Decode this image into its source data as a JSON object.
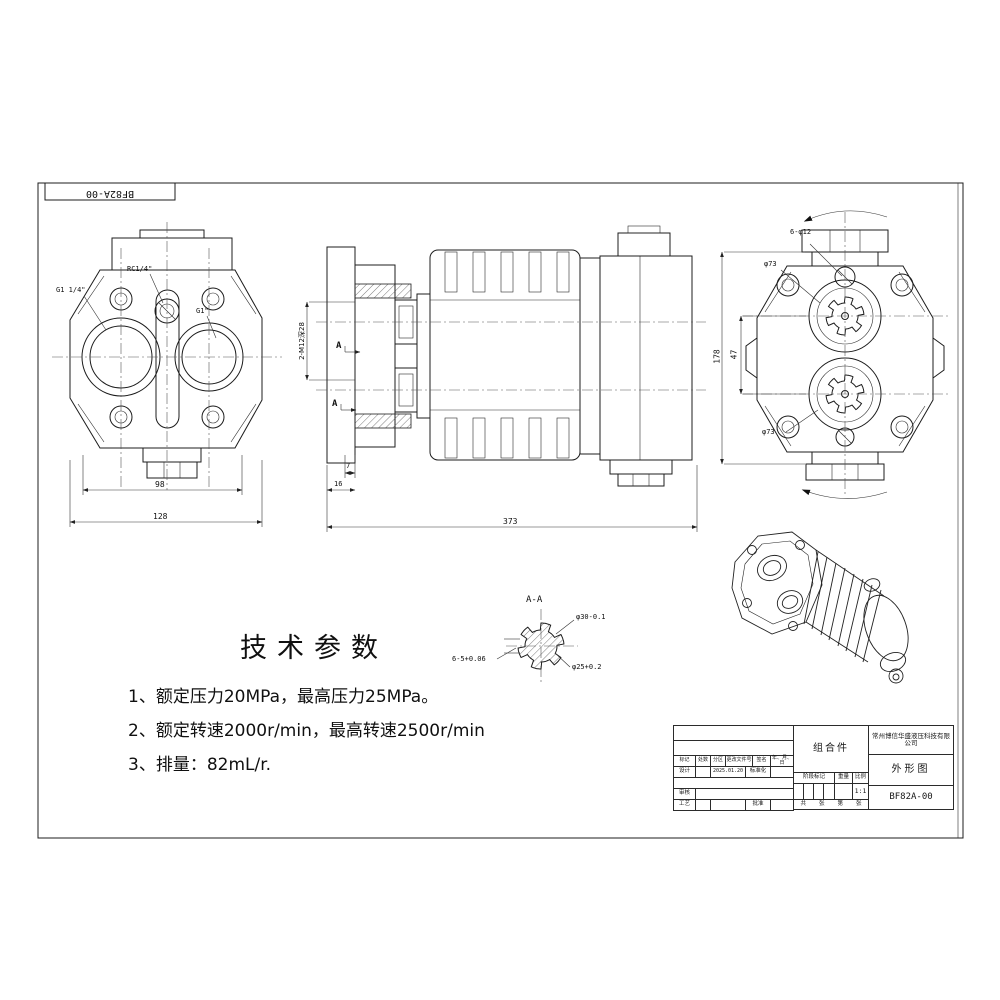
{
  "sheet": {
    "corner_label": "BF82A-00",
    "line_color": "#1c1c1c",
    "background": "#ffffff"
  },
  "tech_params": {
    "title": "技术参数",
    "items": [
      "1、额定压力20MPa，最高压力25MPa。",
      "2、额定转速2000r/min，最高转速2500r/min",
      "3、排量：82mL/r."
    ]
  },
  "views": {
    "front": {
      "port_left": "G1 1/4\"",
      "port_center": "RC1/4\"",
      "port_right": "G1\"",
      "dim_inner": "98",
      "dim_outer": "128"
    },
    "side": {
      "dim_ports": "2-M12深28",
      "section_mark": "A",
      "dim_7": "7",
      "dim_16": "16",
      "dim_total": "373"
    },
    "rear": {
      "bolt_callout": "6-φ12",
      "dia_top": "φ73",
      "dia_bottom": "φ73",
      "dim_centers": "47",
      "dim_height": "178"
    },
    "section": {
      "title": "A-A",
      "dia_major": "φ30-0.1",
      "dia_minor": "φ25+0.2",
      "spline_width": "6-5+0.06"
    }
  },
  "title_block": {
    "company": "常州博信华盛液压科技有限公司",
    "part_name": "组合件",
    "sheet_name": "外形图",
    "drawing_no": "BF82A-00",
    "scale_value": "1:1",
    "headers": {
      "mark": "标记",
      "count": "处数",
      "zone": "分区",
      "change_no": "更改文件号",
      "sign": "签名",
      "date": "年、月、日"
    },
    "fields": {
      "design": "设计",
      "design_date": "2025.01.20",
      "standardize": "标准化",
      "check": "审核",
      "process": "工艺",
      "approve": "批准",
      "stage_mark": "阶段标记",
      "weight": "重量",
      "scale_label": "比例",
      "total": "共",
      "sheet": "张",
      "no": "第",
      "sheet2": "张"
    }
  }
}
